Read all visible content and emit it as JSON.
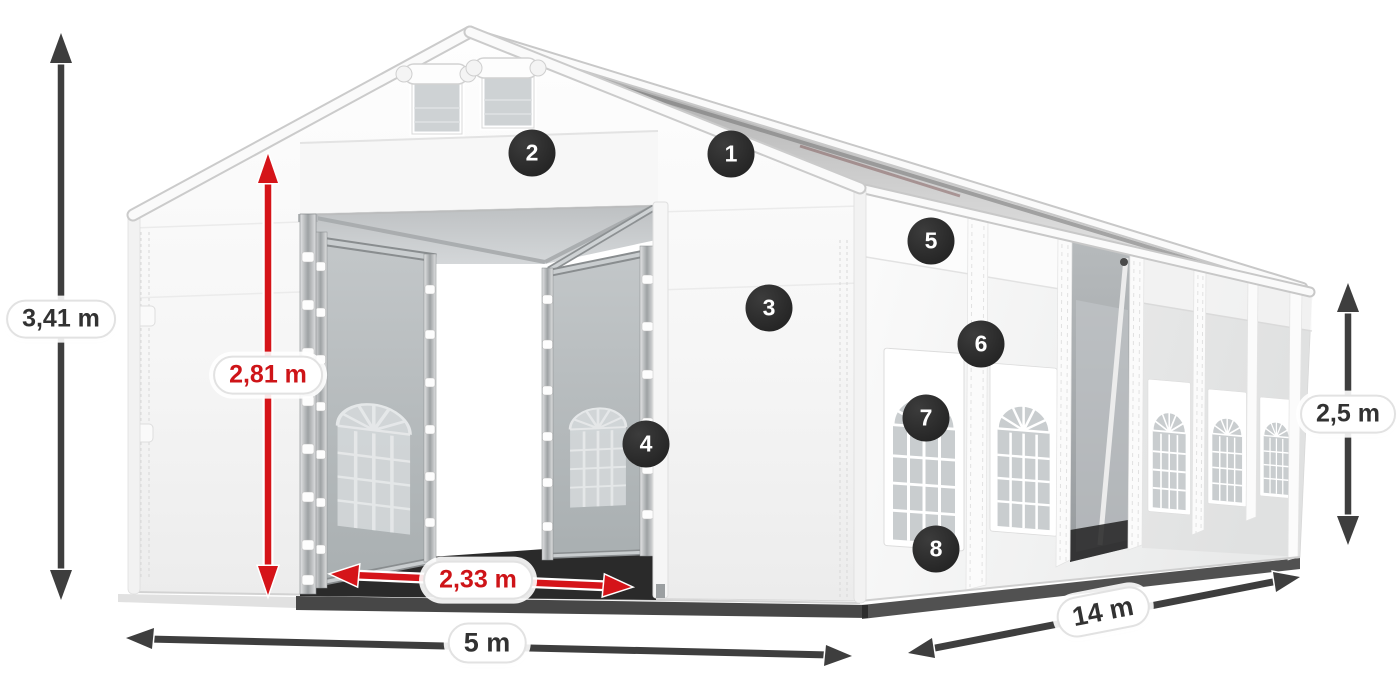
{
  "diagram": {
    "subject": "White marquee party tent shown in 3D perspective with open front entrance, side wall windows and dimension annotations",
    "background": "#ffffff"
  },
  "palette": {
    "tent_white": "#f7f7f7",
    "door_panel_gray": "#b5b9bb",
    "accent_red": "#d51419",
    "arrow_dark": "#3e3e3e",
    "badge_bg": "#262626",
    "badge_text": "#ffffff",
    "label_bg": "#ffffff",
    "label_border": "#e2e2e2",
    "label_text": "#323232"
  },
  "dimensions": [
    {
      "id": "total_height",
      "label": "3,41 m",
      "style": "dark",
      "axis": "vertical"
    },
    {
      "id": "entrance_height",
      "label": "2,81 m",
      "style": "red",
      "axis": "vertical"
    },
    {
      "id": "entrance_width",
      "label": "2,33 m",
      "style": "red",
      "axis": "horizontal"
    },
    {
      "id": "front_width",
      "label": "5 m",
      "style": "dark",
      "axis": "horizontal"
    },
    {
      "id": "side_length",
      "label": "14 m",
      "style": "dark",
      "axis": "diagonal"
    },
    {
      "id": "wall_height",
      "label": "2,5 m",
      "style": "dark",
      "axis": "vertical"
    }
  ],
  "callouts": [
    {
      "number": "1"
    },
    {
      "number": "2"
    },
    {
      "number": "3"
    },
    {
      "number": "4"
    },
    {
      "number": "5"
    },
    {
      "number": "6"
    },
    {
      "number": "7"
    },
    {
      "number": "8"
    }
  ]
}
